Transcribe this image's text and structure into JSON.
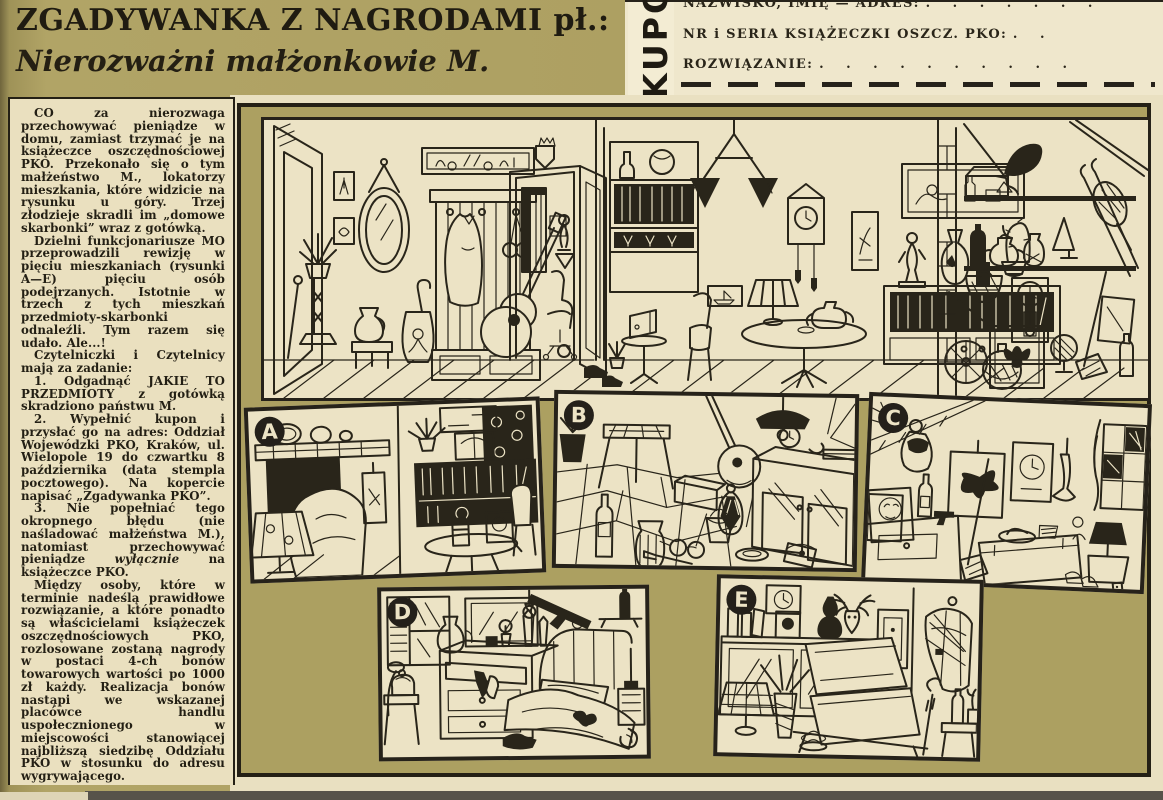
{
  "header": {
    "title": "ZGADYWANKA Z NAGRODAMI pł.:",
    "subtitle": "Nierozważni małżonkowie M."
  },
  "coupon": {
    "vertical_label": "KUPON",
    "row1_label": "NAZWISKO, IMIĘ — ADRES:",
    "row1_dots": ". . . . . . .",
    "row2_label": "NR i SERIA KSIĄŻECZKI OSZCZ. PKO:",
    "row2_dots": ". .",
    "row3_label": "ROZWIĄZANIE:",
    "row3_dots": ". . . . . . . . . ."
  },
  "article": {
    "p1": "CO za nierozwaga przechowywać pieniądze w domu, zamiast trzymać je na książeczce oszczędnościowej PKO. Przekonało się o tym małżeństwo M., lokatorzy mieszkania, które widzicie na rysunku u góry. Trzej złodzieje skradli im „domowe skarbonki” wraz z gotówką.",
    "p2": "Dzielni funkcjonariusze MO przeprowadzili rewizję w pięciu mieszkaniach (rysunki A—E) pięciu osób podejrzanych. Istotnie w trzech z tych mieszkań przedmioty-skarbonki odnaleźli. Tym razem się udało. Ale...!",
    "p3": "Czytelniczki i Czytelnicy mają za zadanie:",
    "p4": "1. Odgadnąć JAKIE TO PRZEDMIOTY z gotówką skradziono państwu M.",
    "p5": "2. Wypełnić kupon i przysłać go na adres: Oddział Wojewódzki PKO, Kraków, ul. Wielopole 19 do czwartku 8 października (data stempla pocztowego). Na kopercie napisać „Zgadywanka PKO”.",
    "p6a": "3. Nie popełniać tego okropnego błędu (nie naśladować małżeństwa M.), natomiast przechowywać pieniądze ",
    "p6b": "wyłącznie",
    "p6c": " na książeczce PKO.",
    "p7": "Między osoby, które w terminie nadeślą prawidłowe rozwiązanie, a które ponadto są właścicielami książeczek oszczędnościowych PKO, rozlosowane zostaną nagrody w postaci 4-ch bonów towarowych wartości po 1000 zł każdy. Realizacja bonów nastąpi we wskazanej placówce handlu uspołecznionego w miejscowości stanowiącej najbliższą siedzibę Oddziału PKO w stosunku do adresu wygrywającego."
  },
  "panels": {
    "labels": [
      "A",
      "B",
      "C",
      "D",
      "E"
    ]
  },
  "colors": {
    "olive_background": "#ada062",
    "paper": "#eae0bf",
    "ink": "#26221a",
    "panel_paper": "#ece3c5"
  }
}
